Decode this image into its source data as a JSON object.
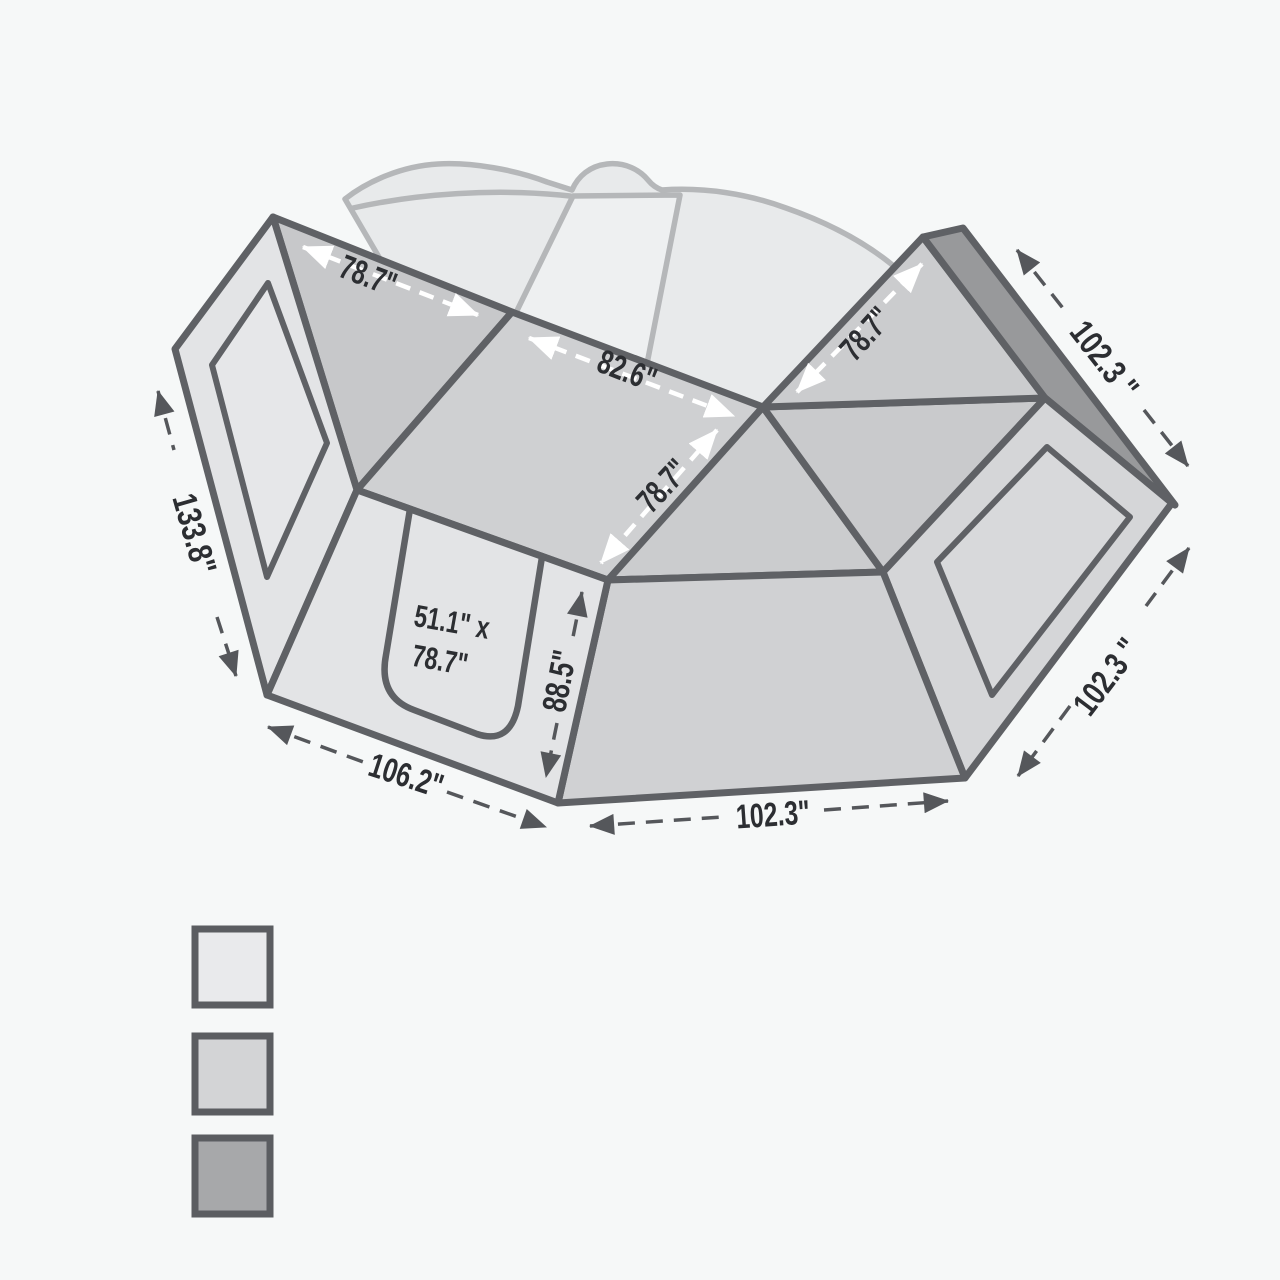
{
  "dims": {
    "roof_left": "78.7\"",
    "roof_center": "82.6\"",
    "roof_depth": "78.7\"",
    "roof_right": "78.7\"",
    "side_left": "133.8\"",
    "bottom_left": "106.2\"",
    "door_height": "88.5\"",
    "bottom_front": "102.3\"",
    "right_top": "102.3 \"",
    "right_side": "102.3 \"",
    "door_line1": "51.1\" x",
    "door_line2": "78.7\""
  },
  "colors": {
    "background": "#f6f8f8",
    "outline": "#5f6165",
    "dark_arrow": "#55575b",
    "white_arrow": "#ffffff",
    "text": "#2c2e32",
    "ghost_vehicle": "#b5b7b9",
    "wall_light": "#e3e4e6",
    "roof_mid": "#cfd0d2",
    "edge_dark": "#98999b"
  },
  "legend": {
    "swatches": [
      "#e9eaec",
      "#d3d4d6",
      "#a7a8aa"
    ]
  }
}
